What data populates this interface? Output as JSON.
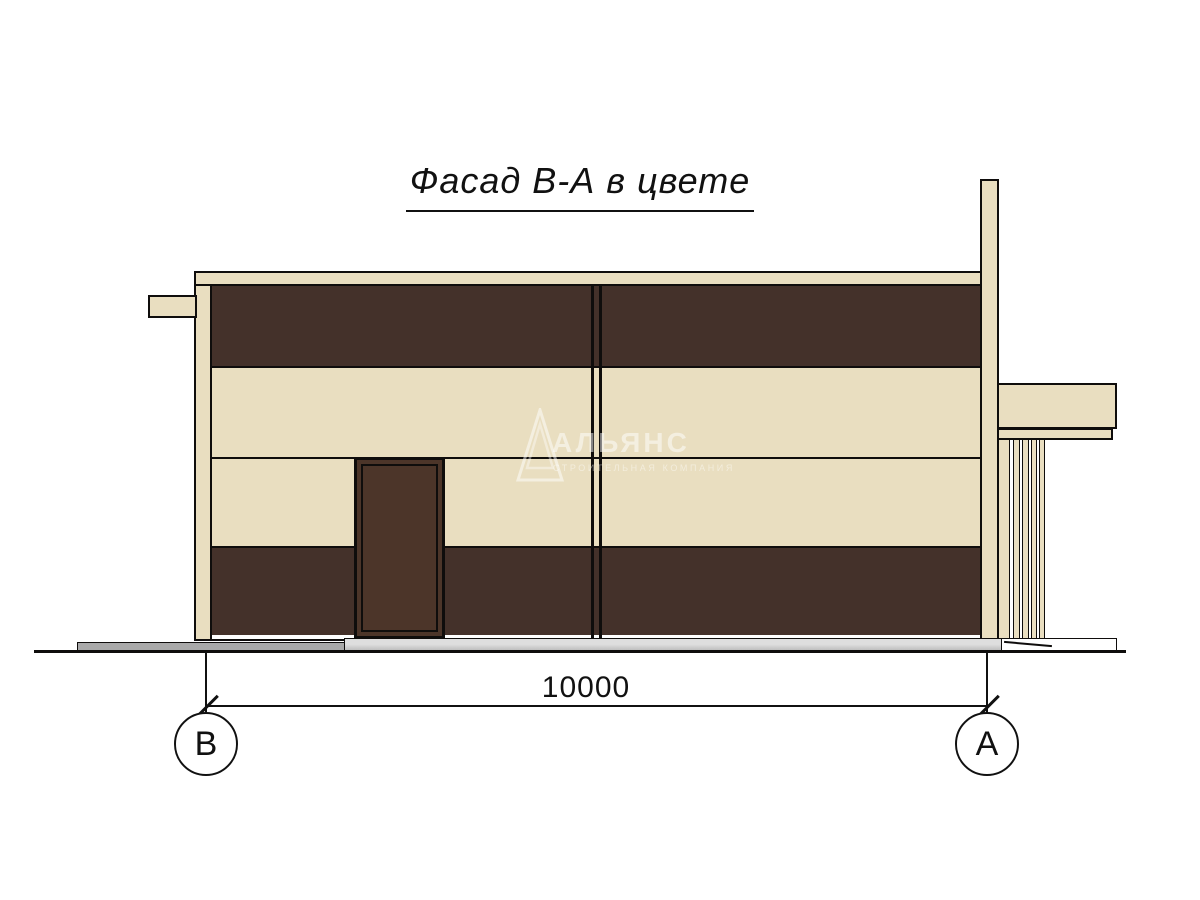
{
  "drawing": {
    "title": "Фасад В-А в цвете"
  },
  "dimension": {
    "value": "10000"
  },
  "axis_markers": {
    "left": "В",
    "right": "А"
  },
  "watermark": {
    "brand": "АЛЬЯНС",
    "tagline": "СТРОИТЕЛЬНАЯ КОМПАНИЯ"
  },
  "colors": {
    "cream": "#e9dec0",
    "brown": "#44312a",
    "door_brown": "#4c3529",
    "ink": "#0f0d0c",
    "gray_light": "#cdcdcd",
    "gray_dark": "#a9a9a9",
    "paper": "#ffffff"
  }
}
